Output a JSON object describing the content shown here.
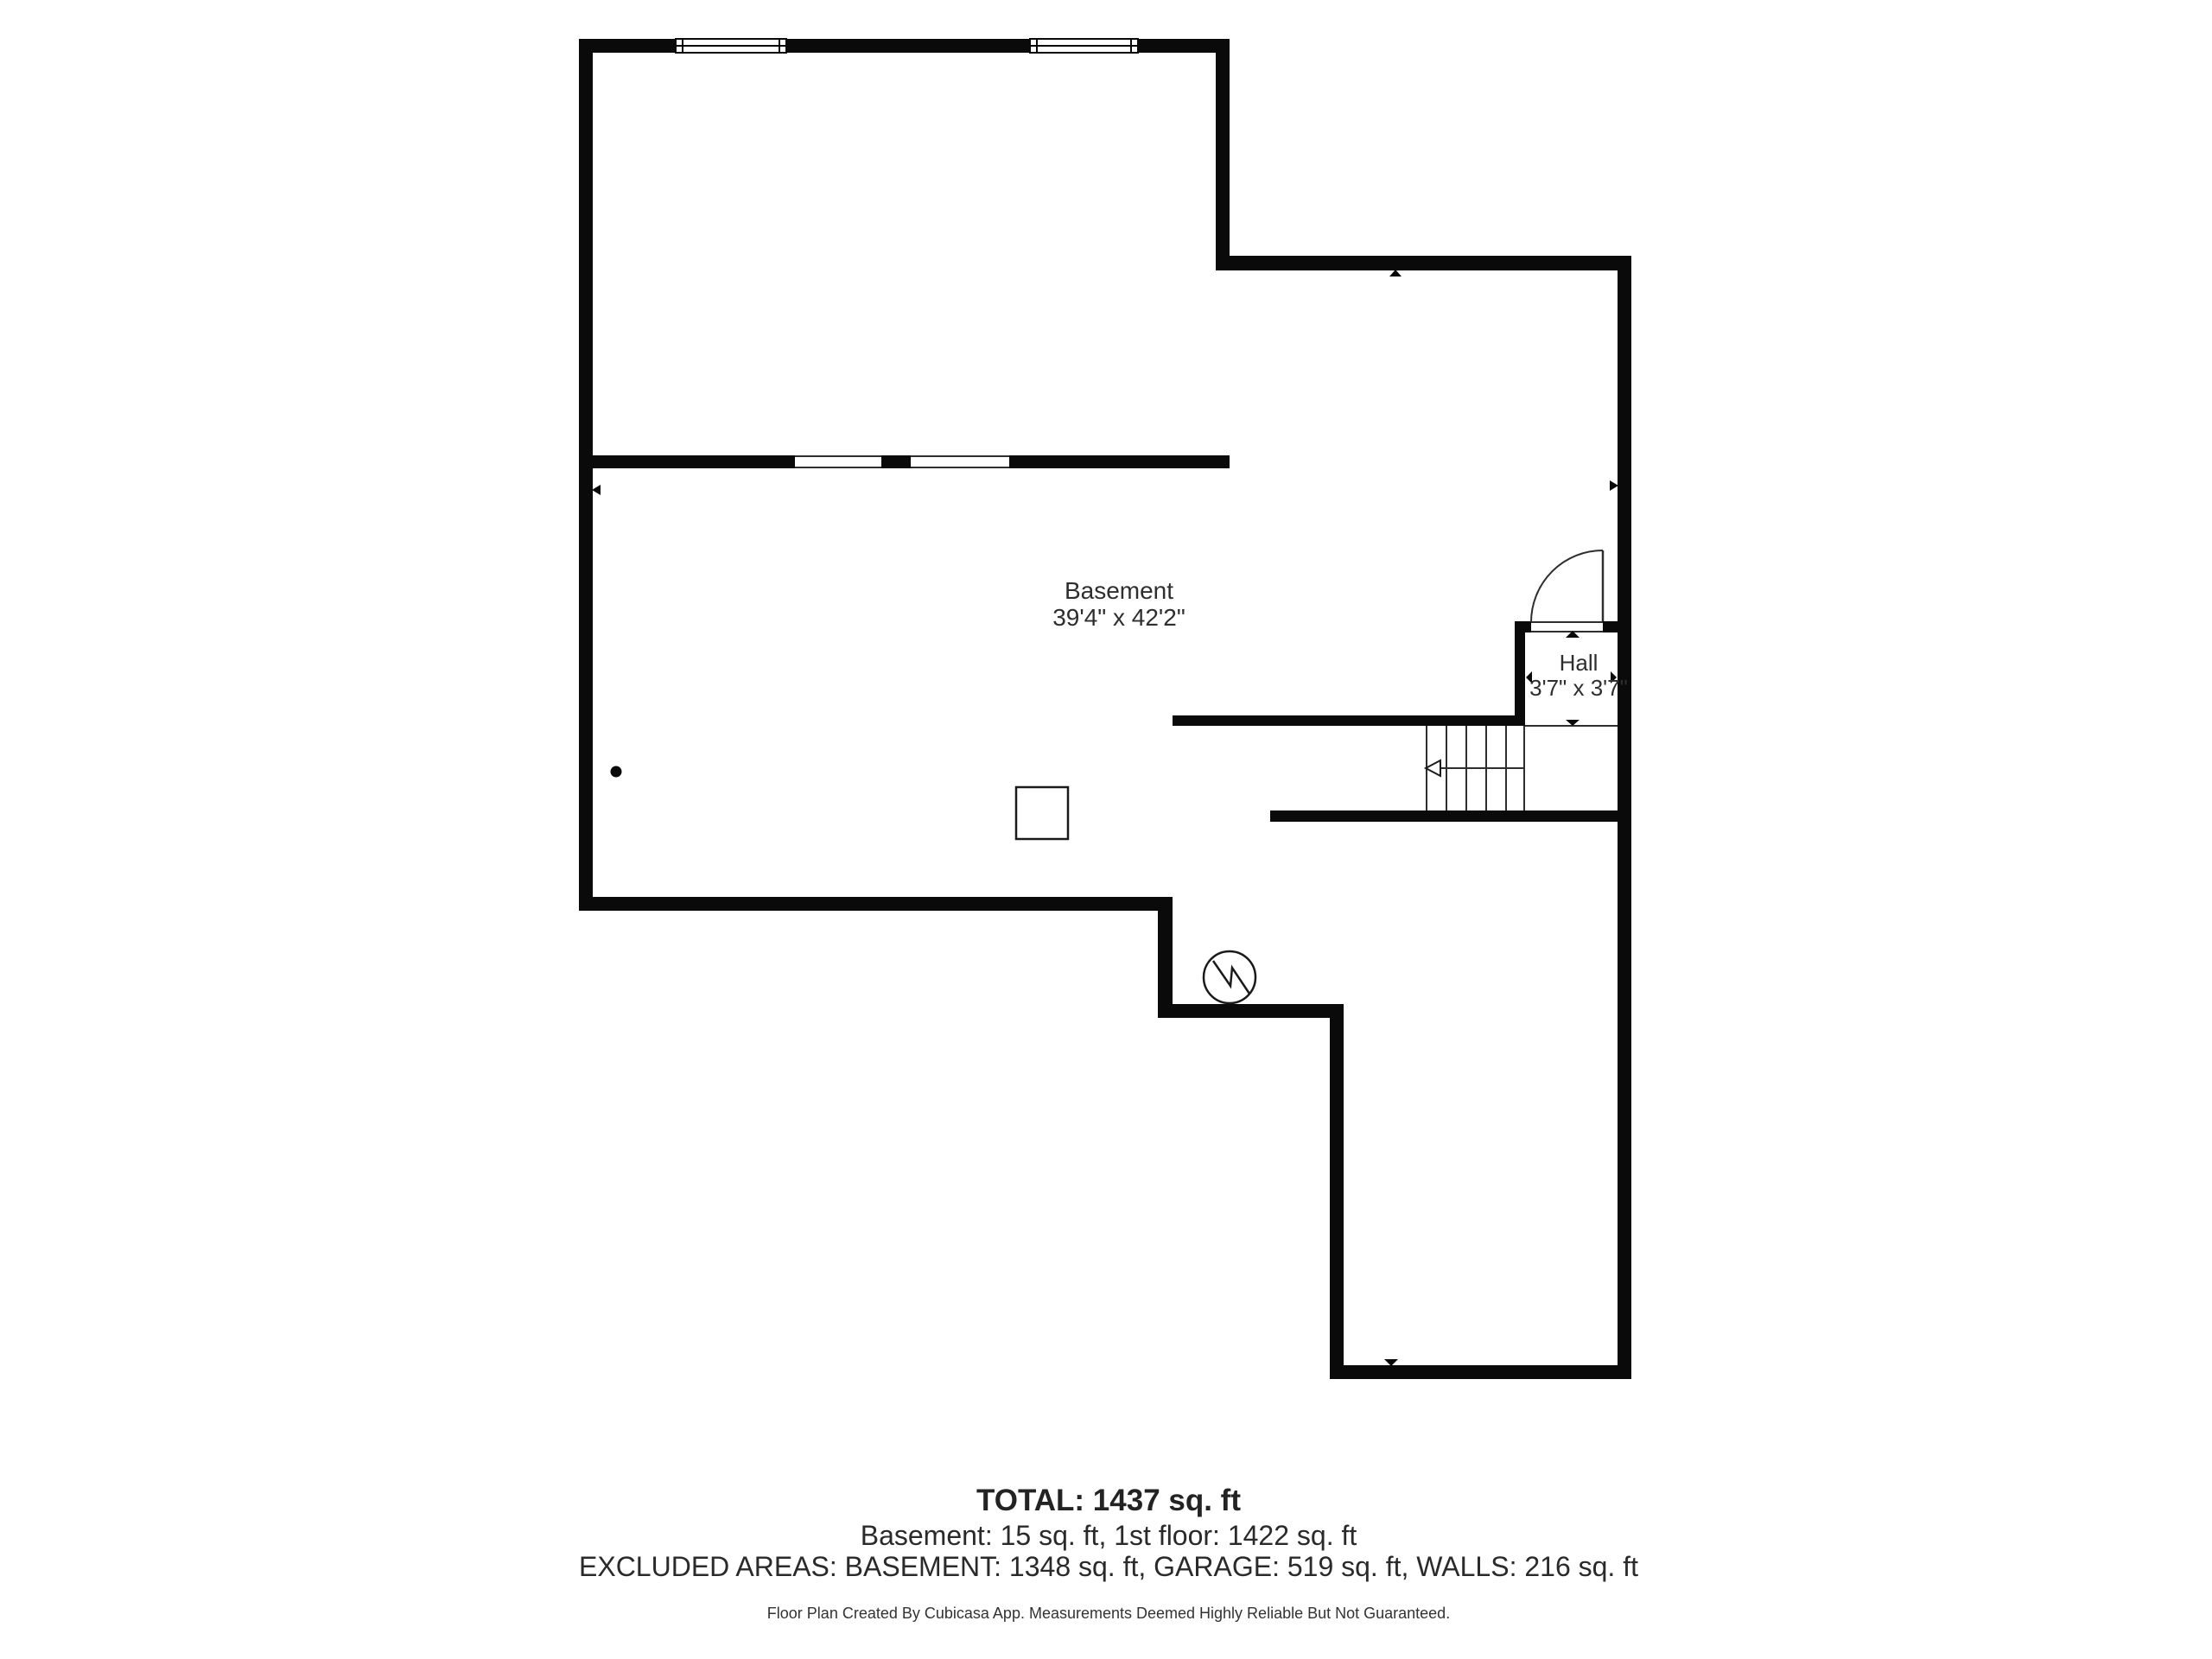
{
  "floor_plan": {
    "rooms": [
      {
        "name": "Basement",
        "dimensions": "39'4\" x 42'2\""
      },
      {
        "name": "Hall",
        "dimensions": "3'7\" x 3'7\""
      }
    ],
    "summary": {
      "total": "TOTAL: 1437 sq. ft",
      "floors": "Basement: 15 sq. ft, 1st floor: 1422 sq. ft",
      "excluded": "EXCLUDED AREAS: BASEMENT: 1348 sq. ft, GARAGE: 519 sq. ft, WALLS: 216 sq. ft"
    },
    "footer": "Floor Plan Created By Cubicasa App. Measurements Deemed Highly Reliable But Not Guaranteed.",
    "colors": {
      "wall": "#0a0a0a",
      "thin_line": "#2e2e2e",
      "text": "#2e2e2e",
      "background": "#ffffff"
    }
  }
}
